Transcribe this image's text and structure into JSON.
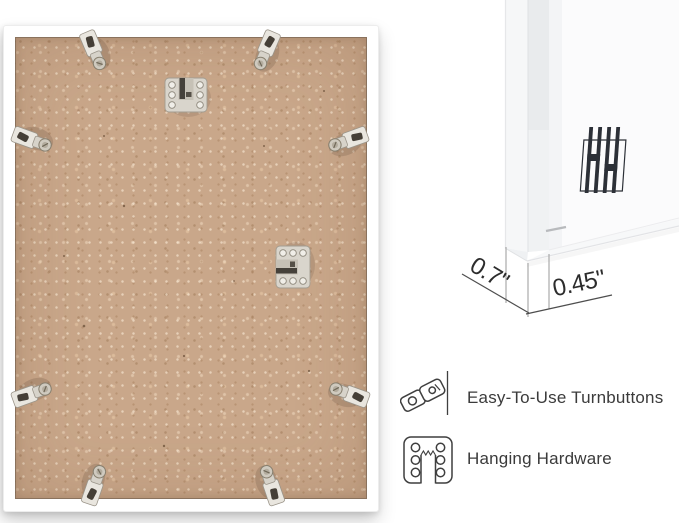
{
  "page": {
    "background": "#ffffff"
  },
  "frame_back_view": {
    "frame_color": "#ffffff",
    "backing_color": "#c9a78a",
    "turnbutton_count": 8,
    "hanger_count": 2
  },
  "corner_detail_view": {
    "logo_monogram": "HH",
    "depth_label": "0.7\"",
    "face_width_label": "0.45\""
  },
  "feature_legend": [
    {
      "icon": "turnbutton-icon",
      "label": "Easy-To-Use Turnbuttons"
    },
    {
      "icon": "hanging-hardware-icon",
      "label": "Hanging Hardware"
    }
  ],
  "palette": {
    "metal": "#d8d4cb",
    "metal_edge": "#99927f",
    "dimension_line": "#4e4e4e",
    "extension_line": "#9a9a9a",
    "label_text": "#3b3b3b",
    "logo_color": "#2c3037"
  }
}
